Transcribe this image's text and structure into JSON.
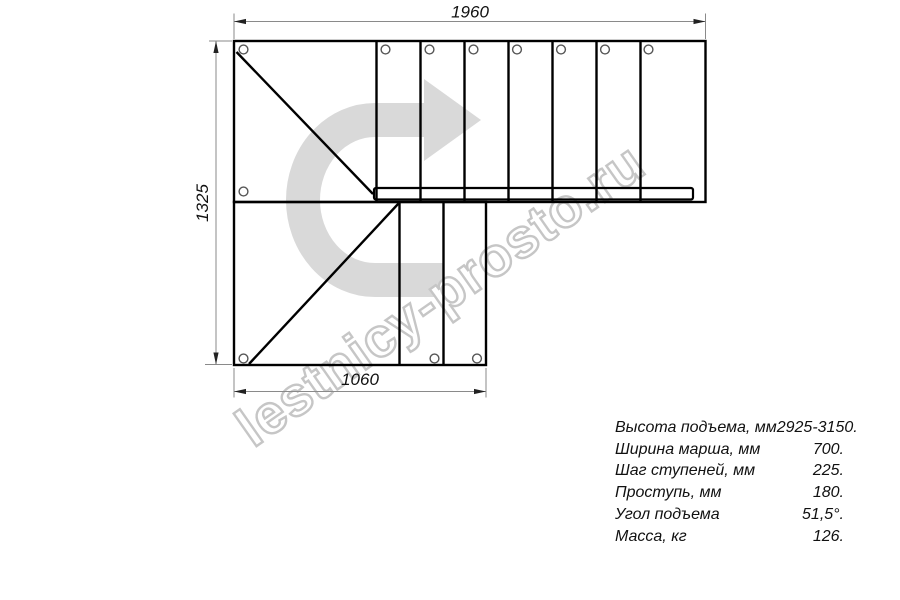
{
  "watermark": {
    "text": "lestnicy-prosto.ru"
  },
  "dimensions": {
    "top_width": "1960",
    "left_height": "1325",
    "bottom_width": "1060"
  },
  "specs": {
    "rows": [
      {
        "label": "Высота подъема, мм",
        "value": "2925-3150."
      },
      {
        "label": "Ширина марша, мм",
        "value": "700."
      },
      {
        "label": "Шаг ступеней, мм",
        "value": "225."
      },
      {
        "label": "Проступь, мм",
        "value": "180."
      },
      {
        "label": "Угол подъема",
        "value": "51,5°."
      },
      {
        "label": "Масса, кг",
        "value": "126."
      }
    ]
  },
  "colors": {
    "line": "#000000",
    "dimension": "#8a8a8a",
    "arrow_head": "#222222",
    "watermark_arrow": "#d9d9d9",
    "watermark_outline": "#c6c6c6"
  }
}
